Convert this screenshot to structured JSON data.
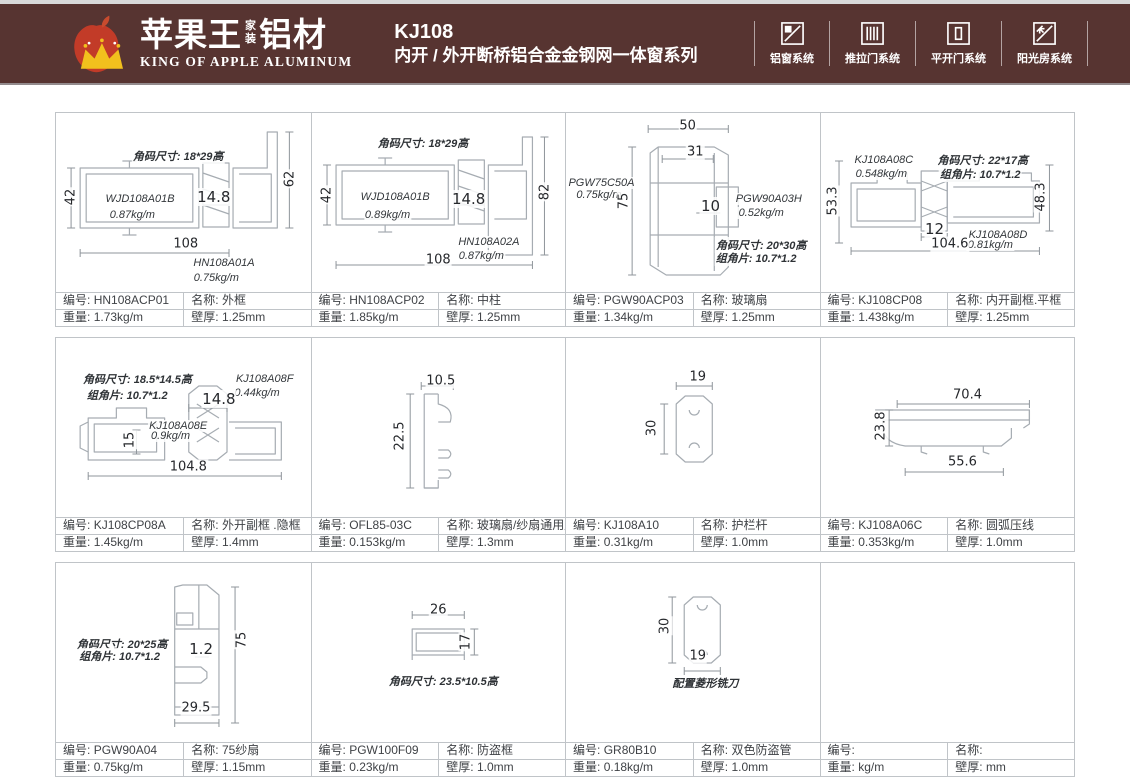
{
  "header": {
    "brand": {
      "cn_main": "苹果王",
      "cn_sub_top": "家",
      "cn_sub_bottom": "装",
      "cn_suffix": "铝材",
      "en": "KING OF APPLE ALUMINUM"
    },
    "title": {
      "model": "KJ108",
      "series": "内开 / 外开断桥铝合金金钢网一体窗系列"
    },
    "systems": [
      {
        "label": "铝窗系统"
      },
      {
        "label": "推拉门系统"
      },
      {
        "label": "平开门系统"
      },
      {
        "label": "阳光房系统"
      }
    ],
    "colors": {
      "header_bg": "#573431",
      "apple_red": "#c23b28",
      "crown_gold": "#f2c01d",
      "grid_border": "#c0c4c8"
    }
  },
  "footer_labels": {
    "id": "编号:",
    "name": "名称:",
    "weight": "重量:",
    "wall": "壁厚:"
  },
  "rows": [
    [
      {
        "id": "HN108ACP01",
        "name": "外框",
        "weight": "1.73kg/m",
        "wall": "1.25mm",
        "shape": "frame62",
        "annotations": [
          {
            "t": "角码尺寸: 18*29高",
            "x": 48,
            "y": 24,
            "c": "note"
          },
          {
            "t": "42",
            "x": 6,
            "y": 47,
            "c": "dimv"
          },
          {
            "t": "WJD108A01B",
            "x": 33,
            "y": 48,
            "c": "lbl"
          },
          {
            "t": "0.87kg/m",
            "x": 30,
            "y": 57,
            "c": "lbl"
          },
          {
            "t": "14.8",
            "x": 62,
            "y": 47,
            "c": "dimb"
          },
          {
            "t": "62",
            "x": 92,
            "y": 37,
            "c": "dimv"
          },
          {
            "t": "108",
            "x": 51,
            "y": 73,
            "c": "dim"
          },
          {
            "t": "HN108A01A",
            "x": 66,
            "y": 84,
            "c": "lbl"
          },
          {
            "t": "0.75kg/m",
            "x": 63,
            "y": 92,
            "c": "lbl"
          }
        ]
      },
      {
        "id": "HN108ACP02",
        "name": "中柱",
        "weight": "1.85kg/m",
        "wall": "1.25mm",
        "shape": "frame82",
        "annotations": [
          {
            "t": "角码尺寸: 18*29高",
            "x": 44,
            "y": 17,
            "c": "note"
          },
          {
            "t": "42",
            "x": 6,
            "y": 46,
            "c": "dimv"
          },
          {
            "t": "WJD108A01B",
            "x": 33,
            "y": 47,
            "c": "lbl"
          },
          {
            "t": "0.89kg/m",
            "x": 30,
            "y": 57,
            "c": "lbl"
          },
          {
            "t": "14.8",
            "x": 62,
            "y": 48,
            "c": "dimb"
          },
          {
            "t": "82",
            "x": 92,
            "y": 44,
            "c": "dimv"
          },
          {
            "t": "HN108A02A",
            "x": 70,
            "y": 72,
            "c": "lbl"
          },
          {
            "t": "0.87kg/m",
            "x": 67,
            "y": 80,
            "c": "lbl"
          },
          {
            "t": "108",
            "x": 50,
            "y": 82,
            "c": "dim"
          }
        ]
      },
      {
        "id": "PGW90ACP03",
        "name": "玻璃扇",
        "weight": "1.34kg/m",
        "wall": "1.25mm",
        "shape": "sash",
        "annotations": [
          {
            "t": "50",
            "x": 48,
            "y": 7,
            "c": "dim"
          },
          {
            "t": "31",
            "x": 51,
            "y": 22,
            "c": "dim"
          },
          {
            "t": "PGW75C50A",
            "x": 14,
            "y": 39,
            "c": "lbl"
          },
          {
            "t": "0.75kg/m",
            "x": 13,
            "y": 46,
            "c": "lbl"
          },
          {
            "t": "75",
            "x": 23,
            "y": 49,
            "c": "dimv"
          },
          {
            "t": "10",
            "x": 57,
            "y": 52,
            "c": "dimb"
          },
          {
            "t": "PGW90A03H",
            "x": 80,
            "y": 48,
            "c": "lbl"
          },
          {
            "t": "0.52kg/m",
            "x": 77,
            "y": 56,
            "c": "lbl"
          },
          {
            "t": "角码尺寸: 20*30高",
            "x": 77,
            "y": 74,
            "c": "note"
          },
          {
            "t": "组角片: 10.7*1.2",
            "x": 75,
            "y": 81,
            "c": "note"
          }
        ]
      },
      {
        "id": "KJ108CP08",
        "name": "内开副框.平框",
        "weight": "1.438kg/m",
        "wall": "1.25mm",
        "shape": "subframe",
        "annotations": [
          {
            "t": "KJ108A08C",
            "x": 25,
            "y": 26,
            "c": "lbl"
          },
          {
            "t": "0.548kg/m",
            "x": 24,
            "y": 34,
            "c": "lbl"
          },
          {
            "t": "角码尺寸: 22*17高",
            "x": 64,
            "y": 26,
            "c": "note"
          },
          {
            "t": "组角片: 10.7*1.2",
            "x": 63,
            "y": 34,
            "c": "note"
          },
          {
            "t": "53.3",
            "x": 5,
            "y": 49,
            "c": "dimv"
          },
          {
            "t": "48.3",
            "x": 87,
            "y": 47,
            "c": "dimv"
          },
          {
            "t": "12",
            "x": 45,
            "y": 65,
            "c": "dimb"
          },
          {
            "t": "KJ108A08D",
            "x": 70,
            "y": 68,
            "c": "lbl"
          },
          {
            "t": "0.81kg/m",
            "x": 67,
            "y": 74,
            "c": "lbl"
          },
          {
            "t": "104.6",
            "x": 51,
            "y": 73,
            "c": "dim"
          }
        ]
      }
    ],
    [
      {
        "id": "KJ108CP08A",
        "name": "外开副框 .隐框",
        "weight": "1.45kg/m",
        "wall": "1.4mm",
        "shape": "hiddenframe",
        "annotations": [
          {
            "t": "角码尺寸: 18.5*14.5高",
            "x": 32,
            "y": 23,
            "c": "note"
          },
          {
            "t": "组角片: 10.7*1.2",
            "x": 28,
            "y": 32,
            "c": "note"
          },
          {
            "t": "KJ108A08F",
            "x": 82,
            "y": 23,
            "c": "lbl"
          },
          {
            "t": "0.44kg/m",
            "x": 79,
            "y": 31,
            "c": "lbl"
          },
          {
            "t": "14.8",
            "x": 64,
            "y": 34,
            "c": "dimb"
          },
          {
            "t": "KJ108A08E",
            "x": 48,
            "y": 49,
            "c": "lbl"
          },
          {
            "t": "0.9kg/m",
            "x": 45,
            "y": 55,
            "c": "lbl"
          },
          {
            "t": "15",
            "x": 29,
            "y": 57,
            "c": "dimv"
          },
          {
            "t": "104.8",
            "x": 52,
            "y": 72,
            "c": "dim"
          }
        ]
      },
      {
        "id": "OFL85-03C",
        "name": "玻璃扇/纱扇通用压线",
        "weight": "0.153kg/m",
        "wall": "1.3mm",
        "shape": "bead",
        "annotations": [
          {
            "t": "10.5",
            "x": 51,
            "y": 24,
            "c": "dim"
          },
          {
            "t": "22.5",
            "x": 35,
            "y": 55,
            "c": "dimv"
          }
        ]
      },
      {
        "id": "KJ108A10",
        "name": "护栏杆",
        "weight": "0.31kg/m",
        "wall": "1.0mm",
        "shape": "rail",
        "annotations": [
          {
            "t": "19",
            "x": 52,
            "y": 22,
            "c": "dim"
          },
          {
            "t": "30",
            "x": 34,
            "y": 50,
            "c": "dimv"
          }
        ]
      },
      {
        "id": "KJ108A06C",
        "name": "圆弧压线",
        "weight": "0.353kg/m",
        "wall": "1.0mm",
        "shape": "arcbead",
        "annotations": [
          {
            "t": "70.4",
            "x": 58,
            "y": 32,
            "c": "dim"
          },
          {
            "t": "23.8",
            "x": 24,
            "y": 49,
            "c": "dimv"
          },
          {
            "t": "55.6",
            "x": 56,
            "y": 69,
            "c": "dim"
          }
        ]
      }
    ],
    [
      {
        "id": "PGW90A04",
        "name": "75纱扇",
        "weight": "0.75kg/m",
        "wall": "1.15mm",
        "shape": "screen75",
        "annotations": [
          {
            "t": "角码尺寸: 20*25高",
            "x": 26,
            "y": 45,
            "c": "note"
          },
          {
            "t": "组角片: 10.7*1.2",
            "x": 25,
            "y": 52,
            "c": "note"
          },
          {
            "t": "1.2",
            "x": 57,
            "y": 48,
            "c": "dimb"
          },
          {
            "t": "75",
            "x": 73,
            "y": 43,
            "c": "dimv"
          },
          {
            "t": "29.5",
            "x": 55,
            "y": 81,
            "c": "dim"
          }
        ]
      },
      {
        "id": "PGW100F09",
        "name": "防盗框",
        "weight": "0.23kg/m",
        "wall": "1.0mm",
        "shape": "box",
        "annotations": [
          {
            "t": "26",
            "x": 50,
            "y": 26,
            "c": "dim"
          },
          {
            "t": "17",
            "x": 61,
            "y": 44,
            "c": "dimv"
          },
          {
            "t": "角码尺寸: 23.5*10.5高",
            "x": 52,
            "y": 66,
            "c": "note"
          }
        ]
      },
      {
        "id": "GR80B10",
        "name": "双色防盗管",
        "weight": "0.18kg/m",
        "wall": "1.0mm",
        "shape": "tube",
        "annotations": [
          {
            "t": "30",
            "x": 39,
            "y": 35,
            "c": "dimv"
          },
          {
            "t": "19",
            "x": 52,
            "y": 52,
            "c": "dim"
          },
          {
            "t": "配置菱形铣刀",
            "x": 55,
            "y": 67,
            "c": "note"
          }
        ]
      },
      {
        "id": "",
        "name": "",
        "weight": "kg/m",
        "wall": "mm",
        "shape": "none",
        "annotations": []
      }
    ]
  ]
}
